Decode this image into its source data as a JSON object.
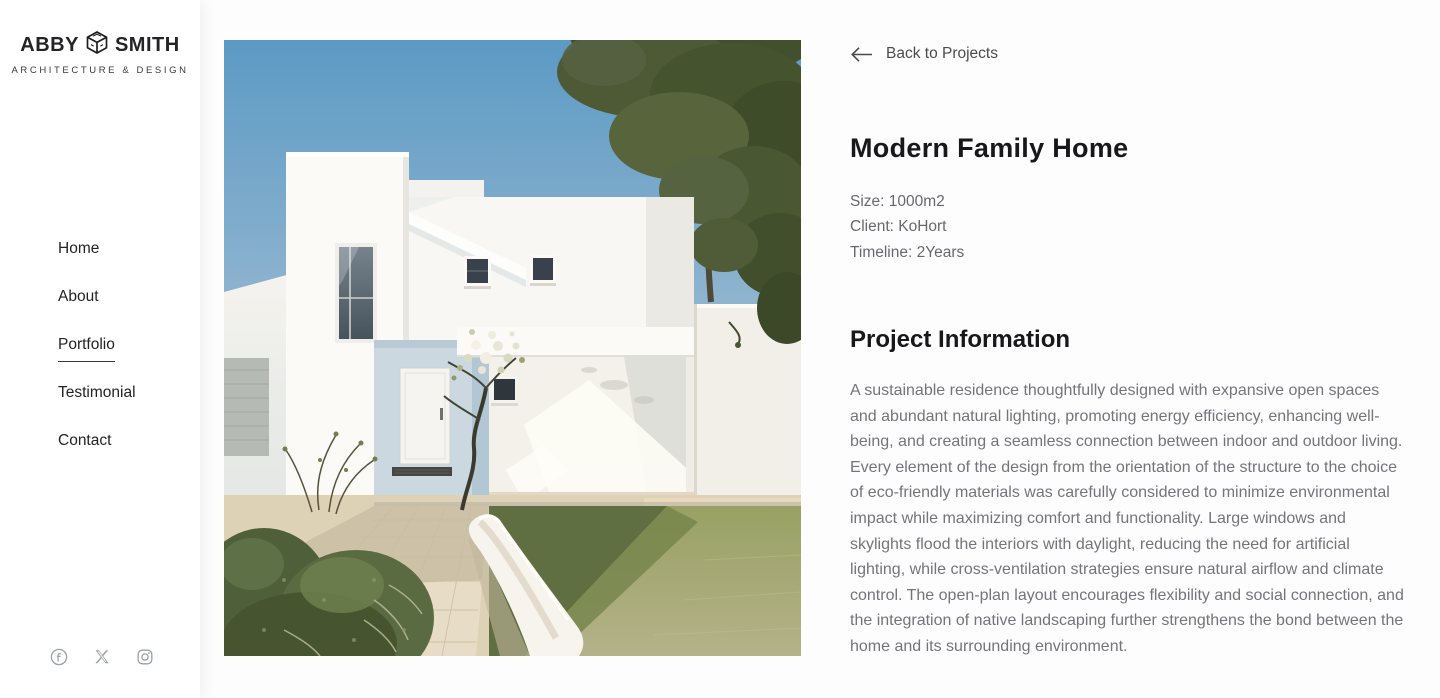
{
  "brand": {
    "first": "ABBY",
    "last": "SMITH",
    "tagline": "ARCHITECTURE & DESIGN",
    "logo_icon": "cube-icon"
  },
  "sidebar": {
    "nav": [
      {
        "label": "Home",
        "active": false
      },
      {
        "label": "About",
        "active": false
      },
      {
        "label": "Portfolio",
        "active": true
      },
      {
        "label": "Testimonial",
        "active": false
      },
      {
        "label": "Contact",
        "active": false
      }
    ],
    "social_icons": [
      "facebook-icon",
      "x-icon",
      "instagram-icon"
    ]
  },
  "main": {
    "back": {
      "icon": "arrow-left-icon",
      "label": "Back to Projects"
    },
    "title": "Modern Family Home",
    "meta": [
      "Size: 1000m2",
      "Client: KoHort",
      "Timeline: 2Years"
    ],
    "section_heading": "Project Information",
    "description": "A sustainable residence thoughtfully designed with expansive open spaces and abundant natural lighting, promoting energy efficiency, enhancing well-being, and creating a seamless connection between indoor and outdoor living. Every element of the design from the orientation of the structure to the choice of eco-friendly materials was carefully considered to minimize environmental impact while maximizing comfort and functionality. Large windows and skylights flood the interiors with daylight, reducing the need for artificial lighting, while cross-ventilation strategies ensure natural airflow and climate control. The open-plan layout encourages flexibility and social connection, and the integration of native landscaping further strengthens the bond between the home and its surrounding environment.",
    "photo": "modern-white-house-photo"
  },
  "colors": {
    "text_dark": "#18181b",
    "text_muted": "#74747b",
    "link_gray": "#4b4b4d",
    "icon_gray": "#9aa0a5",
    "active_underline": "#3a3a3a"
  }
}
